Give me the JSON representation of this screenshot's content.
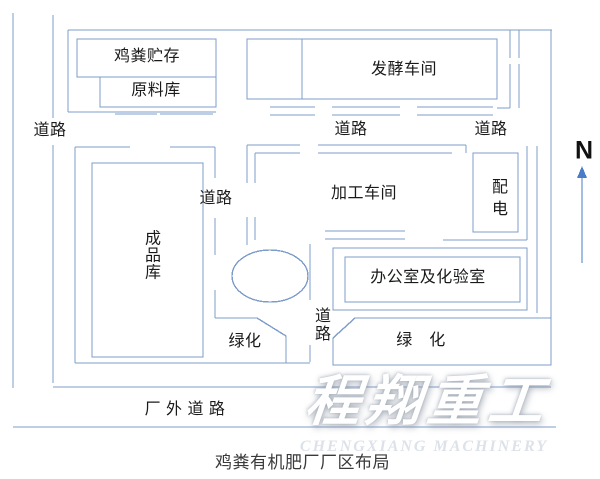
{
  "diagram": {
    "caption": "鸡粪有机肥厂厂区布局",
    "compass": "N",
    "buildings": {
      "manure_storage": "鸡粪贮存",
      "raw_material_warehouse": "原料库",
      "fermentation_workshop": "发酵车间",
      "processing_workshop": "加工车间",
      "power_distribution": "配电",
      "finished_product_warehouse": "成品库",
      "office_and_lab": "办公室及化验室",
      "green_area_left": "绿化",
      "green_area_right": "绿　化"
    },
    "roads": {
      "outer_west": "道路",
      "inner_mid": "道路",
      "inner_east": "道路",
      "inner_west": "道路",
      "inner_south": "道路",
      "outer_south": "厂 外 道 路"
    }
  },
  "watermark": {
    "brand": "程翔重工",
    "brand_en": "CHENGXIANG MACHINERY"
  },
  "colors": {
    "line": "#7E9CC9",
    "compass_arrow": "#4a7cc7",
    "text": "#1a1a1a",
    "watermark_en": "#dde2ea"
  }
}
